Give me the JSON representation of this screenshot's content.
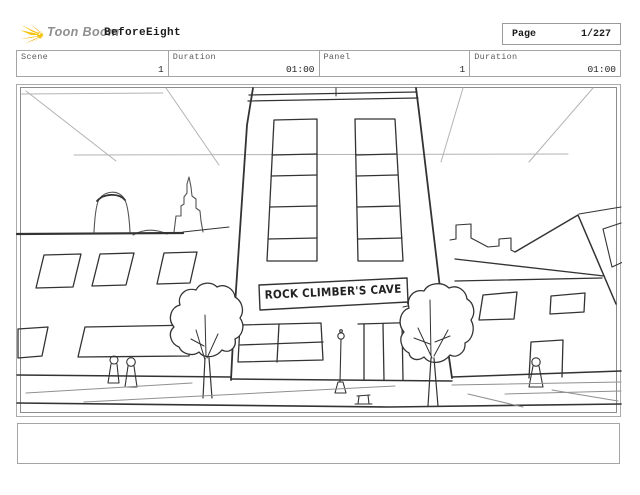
{
  "header": {
    "brand": "Toon Boom",
    "project_title": "BeforeEight",
    "page_label": "Page",
    "page_value": "1/227"
  },
  "info_bar": {
    "cells": [
      {
        "label": "Scene",
        "value": "1"
      },
      {
        "label": "Duration",
        "value": "01:00"
      },
      {
        "label": "Panel",
        "value": "1"
      },
      {
        "label": "Duration",
        "value": "01:00"
      }
    ]
  },
  "panel": {
    "sign_text": "ROCK CLIMBER'S CAVE"
  },
  "caption": {
    "text": ""
  },
  "colors": {
    "logo_yellow": "#f6c410",
    "logo_orange": "#ee9c00",
    "sketch_ink": "#333333",
    "guide_gray": "#b3b3b3",
    "street_gray": "#8f8f8f",
    "border_gray": "#a5a5a5"
  }
}
